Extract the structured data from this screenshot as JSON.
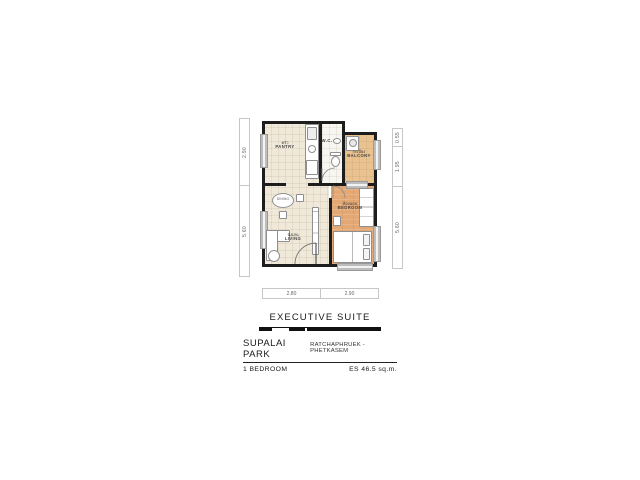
{
  "footer": {
    "title": "EXECUTIVE SUITE",
    "project": "SUPALAI PARK",
    "location": "RATCHAPHRUEK - PHETKASEM",
    "unit_type": "1 BEDROOM",
    "area": "ES 46.5 sq.m."
  },
  "rooms": {
    "pantry": {
      "th": "ครัว",
      "en": "PANTRY"
    },
    "wc": {
      "en": "W.C."
    },
    "balcony": {
      "th": "ระเบียง",
      "en": "BALCONY"
    },
    "living": {
      "th": "นั่งเล่น",
      "en": "LIVING"
    },
    "bedroom": {
      "th": "ห้องนอน",
      "en": "BEDROOM"
    },
    "dining": {
      "en": "DINING"
    }
  },
  "dimensions": {
    "left": [
      "2.90",
      "5.60"
    ],
    "right": [
      "0.55",
      "1.95",
      "5.60"
    ],
    "bottom": [
      "2.80",
      "2.90"
    ]
  },
  "colors": {
    "wall": "#1d1d1d",
    "floor_beige": "#f0e8d8",
    "floor_wc": "#f8f6f1",
    "floor_wood": "#e3a873",
    "floor_balcony": "#eac28f",
    "window_gray": "#bdbdbd"
  }
}
